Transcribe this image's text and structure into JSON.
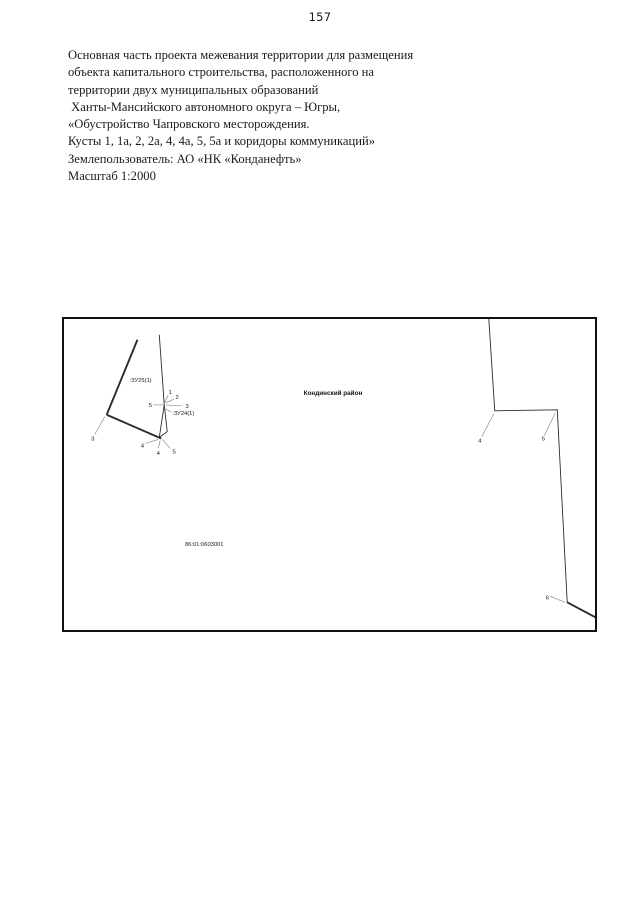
{
  "page_number": "157",
  "title_block": {
    "lines": [
      "Основная часть проекта межевания территории для размещения",
      "объекта капитального строительства, расположенного на",
      "территории двух муниципальных образований",
      " Ханты-Мансийского автономного округа – Югры,",
      "«Обустройство Чапровского месторождения.",
      "Кусты 1, 1а, 2, 2а, 4, 4а, 5, 5а и коридоры коммуникаций»",
      "Землепользователь: АО «НК «Конданефть»",
      "Масштаб 1:2000"
    ]
  },
  "map": {
    "district_label": "Кондинский район",
    "cadastral_quarter_label": "86:01:0603001",
    "parcels": {
      "upper": ":ЗУ25(1)",
      "lower": ":ЗУ24(1)"
    },
    "left_points": {
      "n1": "1",
      "n2": "2",
      "n3": "3",
      "n5": "5",
      "b3": "3",
      "b4a": "4",
      "b4b": "4",
      "b5": "5"
    },
    "right_points": {
      "n4": "4",
      "n5": "5",
      "n6": "6"
    }
  },
  "colors": {
    "boundary_line": "#2b2b2b",
    "leader_line": "#7a7a7a",
    "box_border": "#111111",
    "text": "#1a1a1a"
  }
}
